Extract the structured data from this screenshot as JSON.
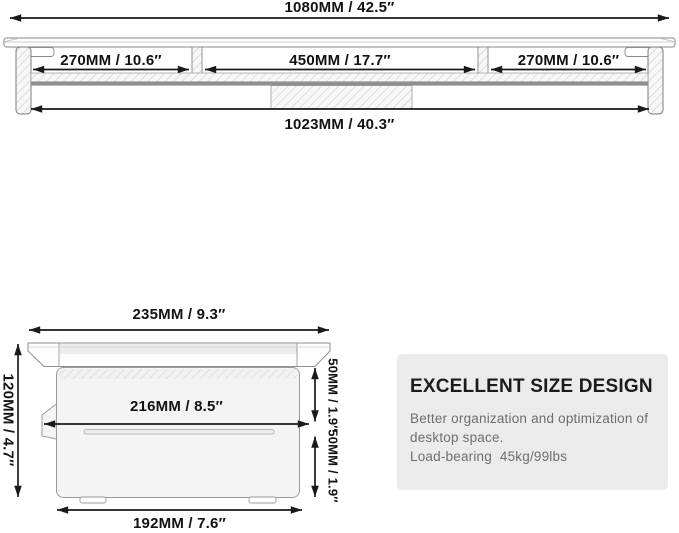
{
  "top_view": {
    "total_width": "1080MM / 42.5″",
    "sections": [
      {
        "label": "270MM / 10.6″"
      },
      {
        "label": "450MM / 17.7″"
      },
      {
        "label": "270MM / 10.6″"
      }
    ],
    "base_width": "1023MM / 40.3″"
  },
  "side_view": {
    "top_width": "235MM / 9.3″",
    "height": "120MM / 4.7″",
    "middle_width": "216MM / 8.5″",
    "upper_clearance": "50MM / 1.9″",
    "lower_clearance": "50MM / 1.9″",
    "base_width": "192MM / 7.6″"
  },
  "info_card": {
    "title": "EXCELLENT SIZE DESIGN",
    "lines": [
      "Better organization and optimization of",
      "desktop space.",
      "Load-bearing  45kg/99lbs"
    ]
  },
  "colors": {
    "dimension_line": "#1a1a1a",
    "outline": "#8a8a8a",
    "hatch_line": "#c9c9c9",
    "card_background": "#ebebeb",
    "body_fill": "#f4f4f4",
    "title_text": "#1b1b1b",
    "body_text": "#6e6e6e"
  }
}
